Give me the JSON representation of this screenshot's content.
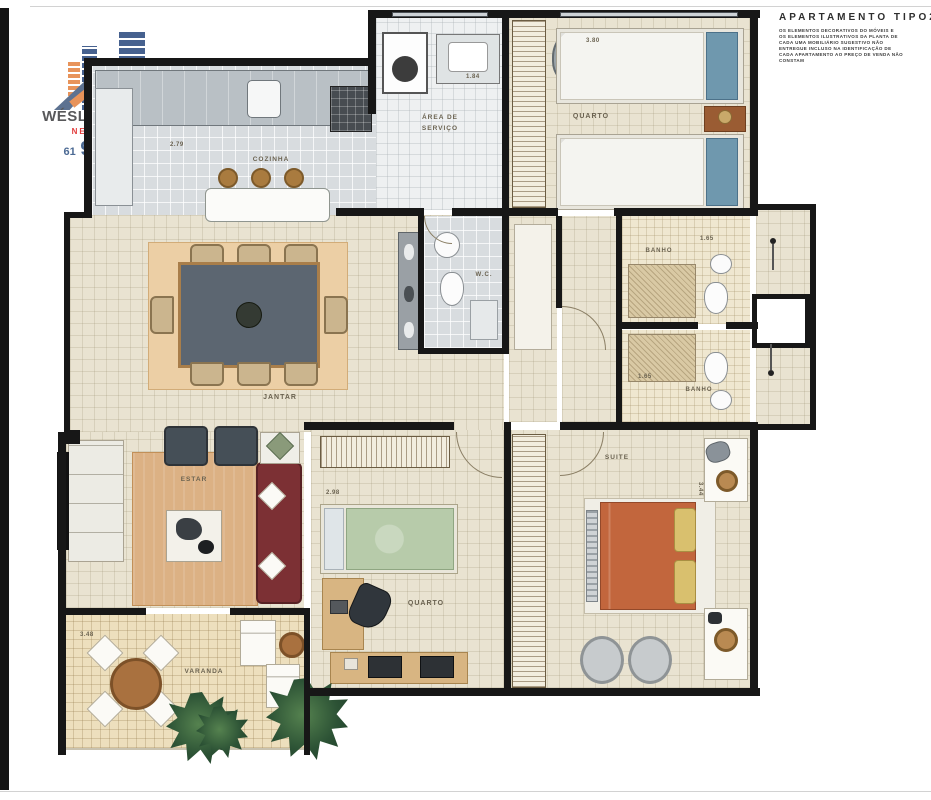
{
  "branding": {
    "name": "WÉSLEY DE OLLIVEIRA",
    "tagline": "NEGÓCIOS & IMÓVEIS",
    "phone_area": "61",
    "phone_number": "9 8122 3954"
  },
  "header": {
    "title": "APARTAMENTO TIPO2",
    "disclaimer_lines": [
      "OS ELEMENTOS DECORATIVOS DO MÓVEIS E",
      "OS ELEMENTOS ILUSTRATIVOS DA PLANTA DE",
      "CADA UMA MOBILIÁRIO SUGESTIVO NÃO",
      "ENTREGUE INCLUSO NA IDENTIFICAÇÃO DE",
      "CADA APARTAMENTO AO PREÇO DE VENDA NÃO",
      "CONSTAM"
    ]
  },
  "rooms": {
    "cozinha": {
      "label": "COZINHA",
      "dim": "2.79"
    },
    "servico": {
      "label": "ÁREA DE SERVIÇO",
      "dim": "1.84"
    },
    "quarto1": {
      "label": "QUARTO",
      "dim": "3.80"
    },
    "banho1": {
      "label": "BANHO",
      "dim": "1.65"
    },
    "banho2": {
      "label": "BANHO",
      "dim": "1.65"
    },
    "wc": {
      "label": "W.C."
    },
    "jantar": {
      "label": "JANTAR"
    },
    "estar": {
      "label": "ESTAR"
    },
    "quarto2": {
      "label": "QUARTO",
      "dim": "2.98"
    },
    "suite": {
      "label": "SUITE",
      "dim": "3.44"
    },
    "varanda": {
      "label": "VARANDA",
      "dim": "3.48"
    }
  },
  "colors": {
    "logo_orange": "#E8935A",
    "logo_blue": "#46618F",
    "tagline_red": "#E23B3B",
    "phone_blue": "#4C6A94",
    "wall_black": "#171717",
    "floor_beige": "#E9E3D1",
    "kitchen_gray": "#D8DCDF",
    "rug_tan": "#ECCFA5",
    "sofa_red": "#7C3034",
    "suite_bed_orange": "#C2663D",
    "bed_green": "#B7CBAA",
    "pillow_blue": "#6F98AE",
    "plant_green": "#2F5D3A",
    "varanda_tan": "#EDDFBD"
  }
}
